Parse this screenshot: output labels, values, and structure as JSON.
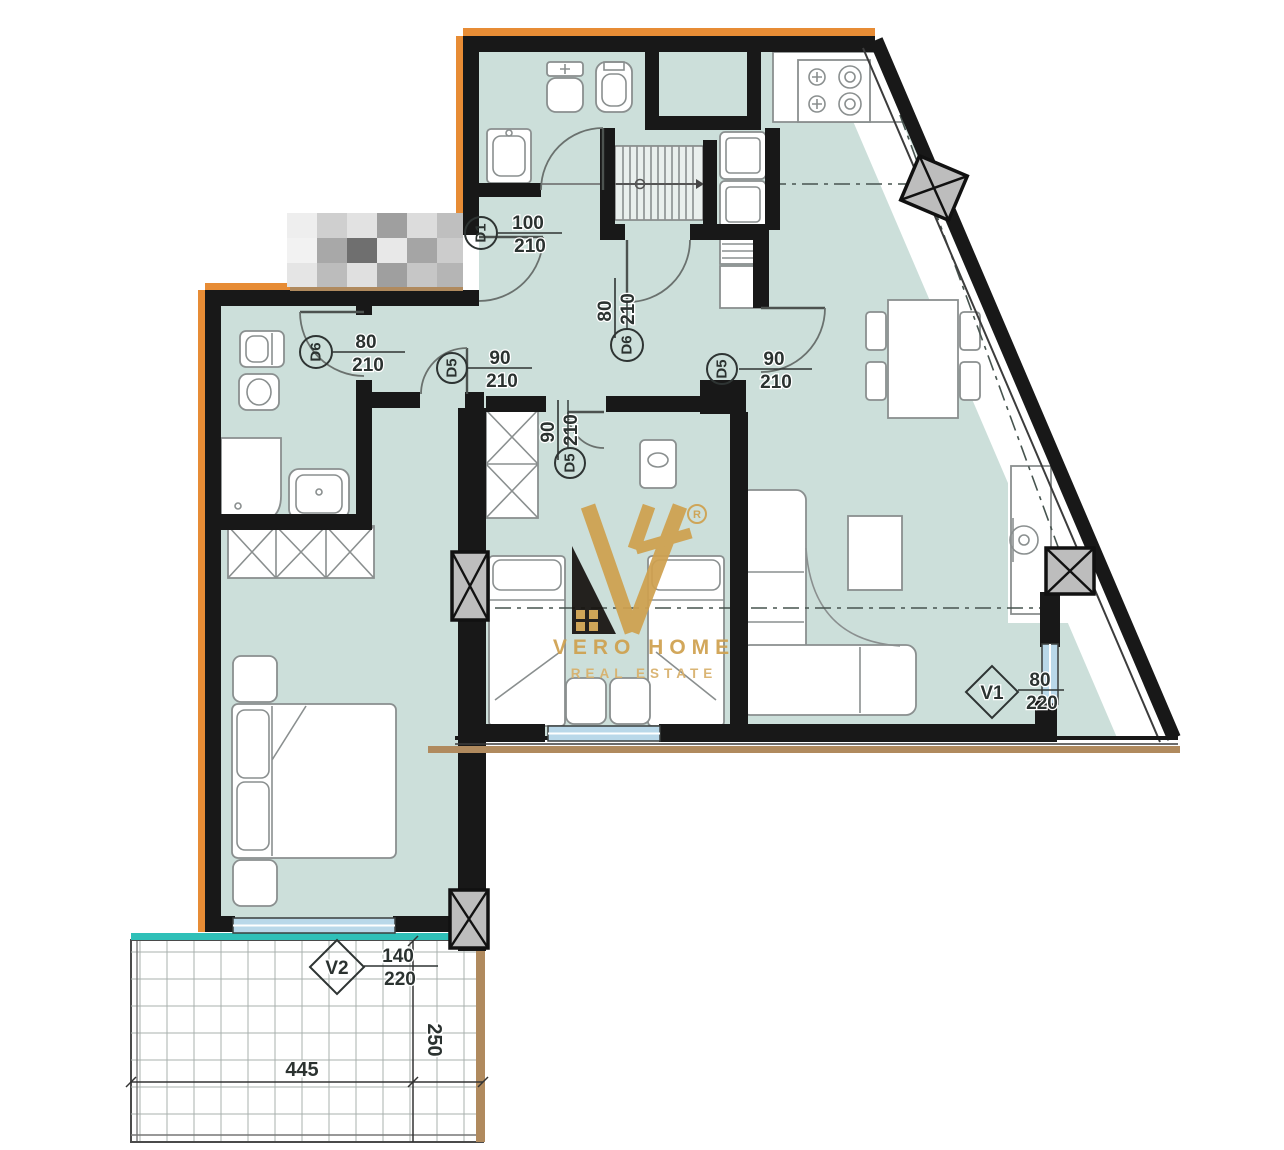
{
  "brand": {
    "monogram": "VH",
    "registered": "R",
    "name": "VERO HOME",
    "tagline": "REAL ESTATE",
    "gold": "#cfa14f",
    "black": "#171310"
  },
  "door_labels": [
    {
      "id": "D1",
      "num": "100",
      "den": "210"
    },
    {
      "id": "D6",
      "num": "80",
      "den": "210"
    },
    {
      "id": "D6",
      "num": "80",
      "den": "210"
    },
    {
      "id": "D5",
      "num": "90",
      "den": "210"
    },
    {
      "id": "D5",
      "num": "90",
      "den": "210"
    },
    {
      "id": "D5",
      "num": "90",
      "den": "210"
    }
  ],
  "window_labels": [
    {
      "id": "V1",
      "num": "80",
      "den": "220"
    },
    {
      "id": "V2",
      "num": "140",
      "den": "220"
    }
  ],
  "dimensions": {
    "balcony_width": "445",
    "balcony_depth": "250"
  },
  "colors": {
    "wall": "#181818",
    "floor": "#ccdfda",
    "insulation_orange": "#e78c35",
    "window_glass": "#b9d8e9",
    "balcony_edge_teal": "#2fc0b8",
    "threshold_tan": "#b08a5e"
  }
}
